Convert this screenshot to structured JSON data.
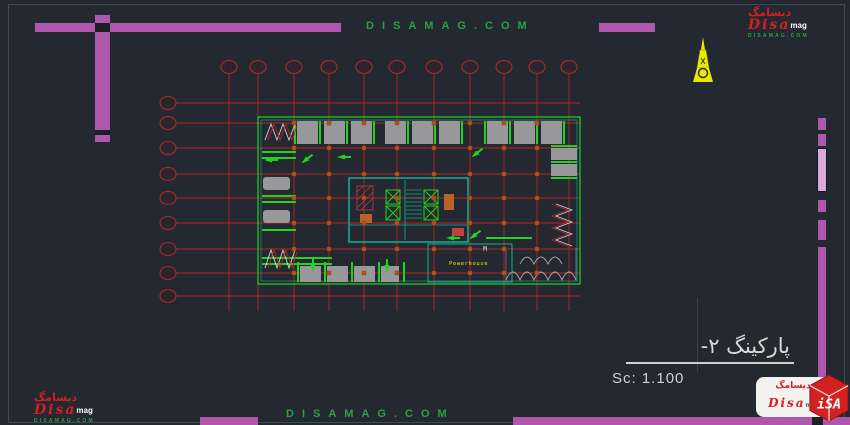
{
  "watermarks": {
    "top": "DISAMAG.COM",
    "bottom": "DISAMAG.COM"
  },
  "brand": {
    "persian_script": "دیسامگ",
    "name": "Disa",
    "suffix": "mag",
    "url": "DISAMAG.COM",
    "cube_text": "iSA"
  },
  "title_block": {
    "drawing_title": "پارکینگ ۲-",
    "scale_label": "Sc: 1.100"
  },
  "plan": {
    "powerhouse_label": "Powerhouse",
    "door_label": "M",
    "grid": {
      "columns": [
        {
          "label": "A",
          "x": 229
        },
        {
          "label": "B",
          "x": 258
        },
        {
          "label": "C",
          "x": 294
        },
        {
          "label": "D",
          "x": 329
        },
        {
          "label": "E",
          "x": 364
        },
        {
          "label": "F",
          "x": 397
        },
        {
          "label": "G",
          "x": 434
        },
        {
          "label": "H",
          "x": 470
        },
        {
          "label": "I",
          "x": 504
        },
        {
          "label": "J",
          "x": 537
        },
        {
          "label": "K",
          "x": 569
        }
      ],
      "rows": [
        {
          "label": "1",
          "y": 103
        },
        {
          "label": "2",
          "y": 123
        },
        {
          "label": "3",
          "y": 148
        },
        {
          "label": "4",
          "y": 174
        },
        {
          "label": "5",
          "y": 198
        },
        {
          "label": "6",
          "y": 223
        },
        {
          "label": "7",
          "y": 249
        },
        {
          "label": "8",
          "y": 273
        },
        {
          "label": "9",
          "y": 296
        }
      ]
    }
  },
  "colors": {
    "background": "#232831",
    "frame": "#3f4a56",
    "accent": "#ad58ad",
    "grid_red": "#bb2424",
    "plan_green": "#1fd41f",
    "teal": "#16b097",
    "stall_gray": "#98989a",
    "watermark_green": "#29a23e",
    "logo_red": "#d42020",
    "highlight_yellow": "#e8e800",
    "column_orange": "#b0541c"
  }
}
